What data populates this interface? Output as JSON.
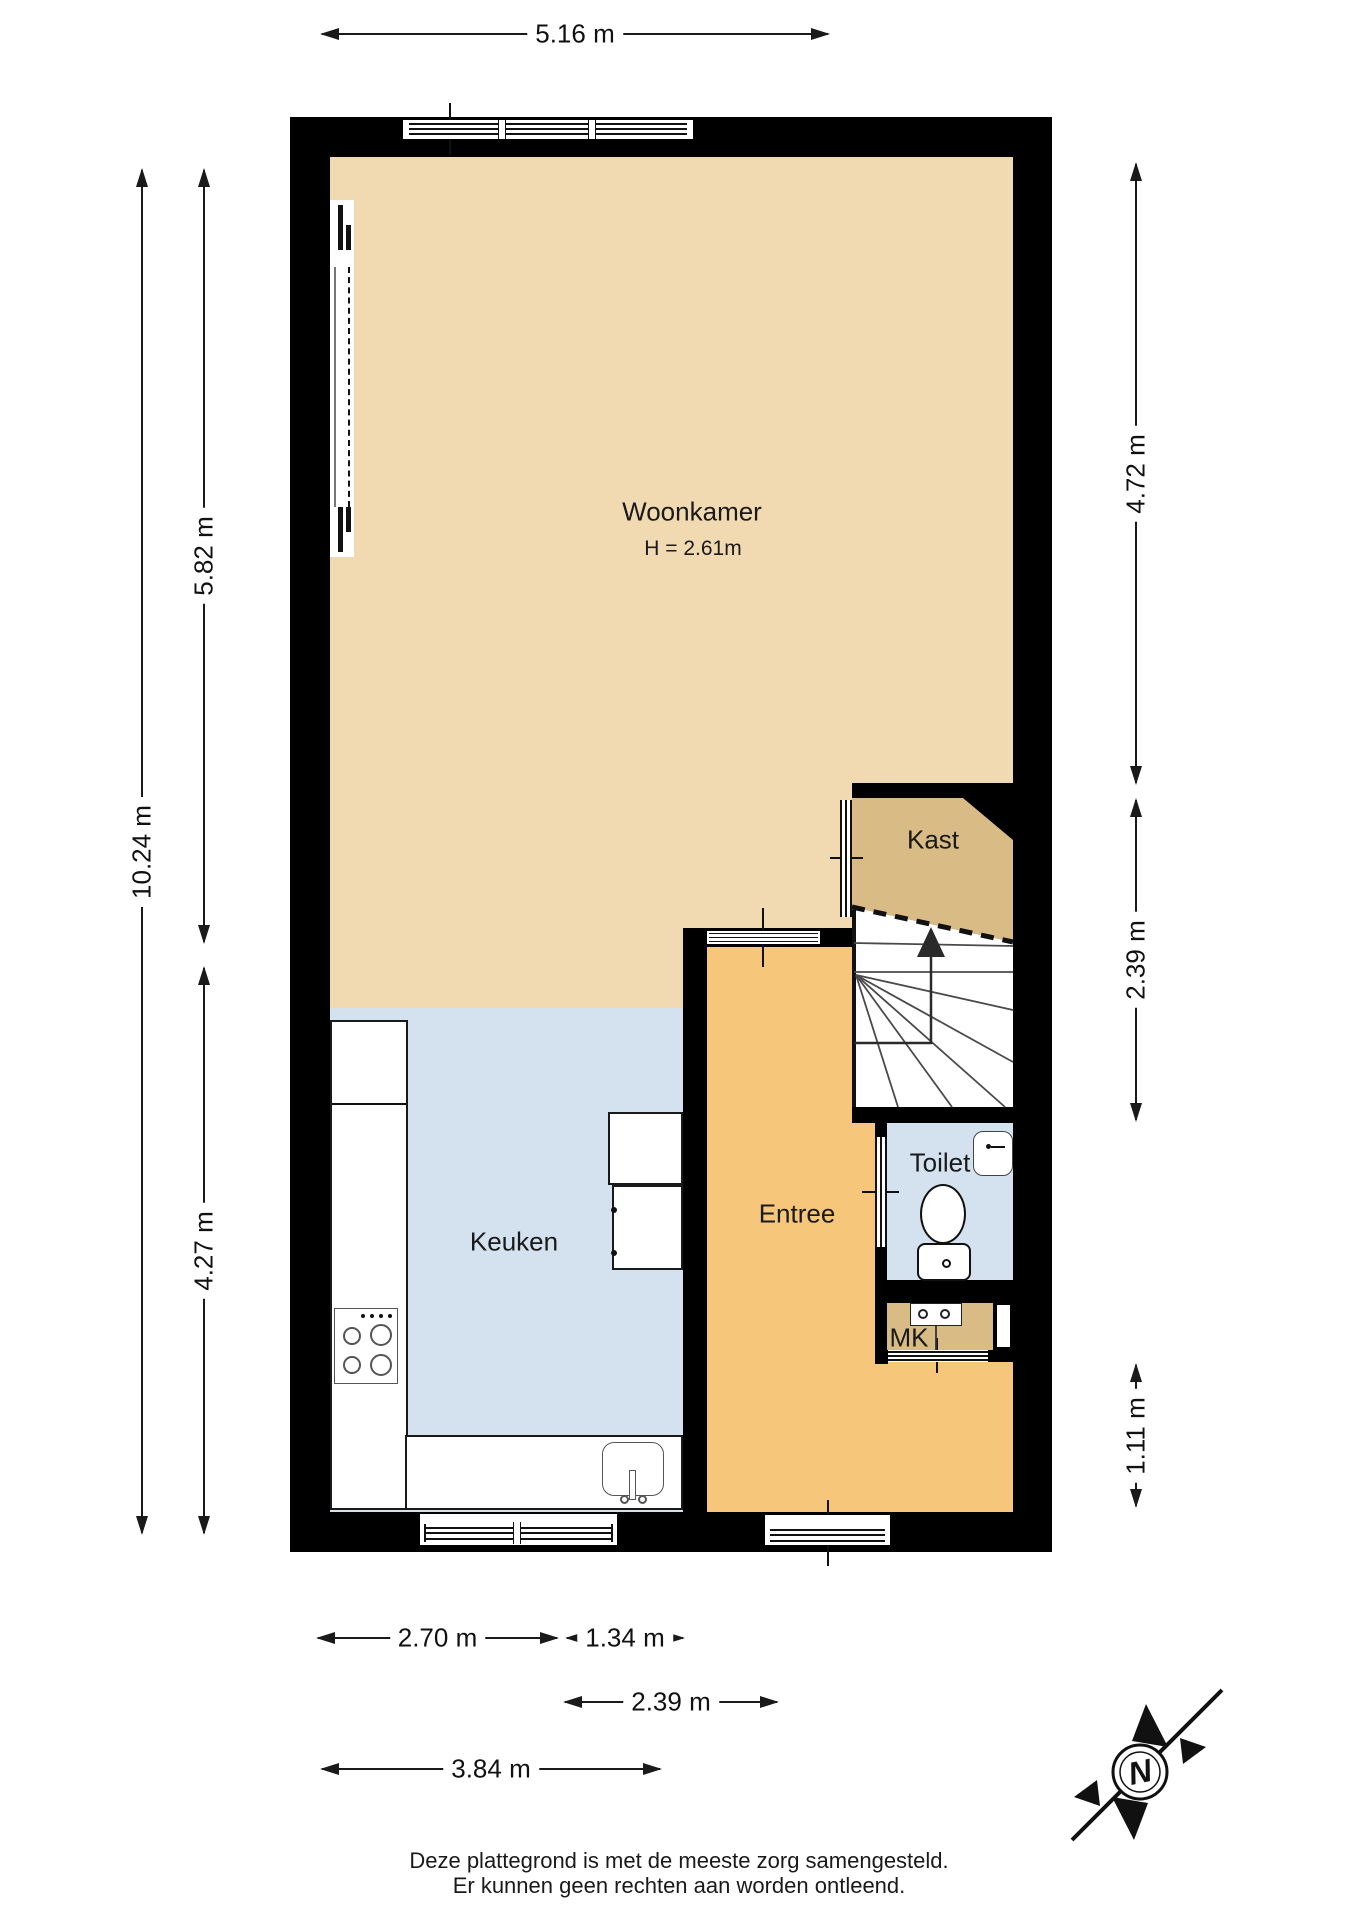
{
  "rooms": {
    "woonkamer": {
      "label": "Woonkamer",
      "height_note": "H = 2.61m"
    },
    "keuken": {
      "label": "Keuken"
    },
    "entree": {
      "label": "Entree"
    },
    "kast": {
      "label": "Kast"
    },
    "toilet": {
      "label": "Toilet"
    },
    "mk": {
      "label": "MK"
    }
  },
  "dimensions": {
    "top_width": "5.16 m",
    "left_total_height": "10.24 m",
    "left_upper_height": "5.82 m",
    "left_lower_height": "4.27 m",
    "right_upper_height": "4.72 m",
    "right_middle_height": "2.39 m",
    "right_lower_height": "1.11 m",
    "bottom_keuken_width": "2.70 m",
    "bottom_entree_width": "1.34 m",
    "bottom_entree_total_width": "2.39 m",
    "bottom_total_width": "3.84 m"
  },
  "compass": {
    "north_label": "N"
  },
  "disclaimer": {
    "line1": "Deze plattegrond is met de meeste zorg samengesteld.",
    "line2": "Er kunnen geen rechten aan worden ontleend."
  },
  "colors": {
    "wall": "#000000",
    "living_floor": "#F1DAB1",
    "kitchen_toilet_floor": "#D4E2F0",
    "hall_floor": "#F6C77B",
    "closet_floor": "#D9BB85"
  }
}
